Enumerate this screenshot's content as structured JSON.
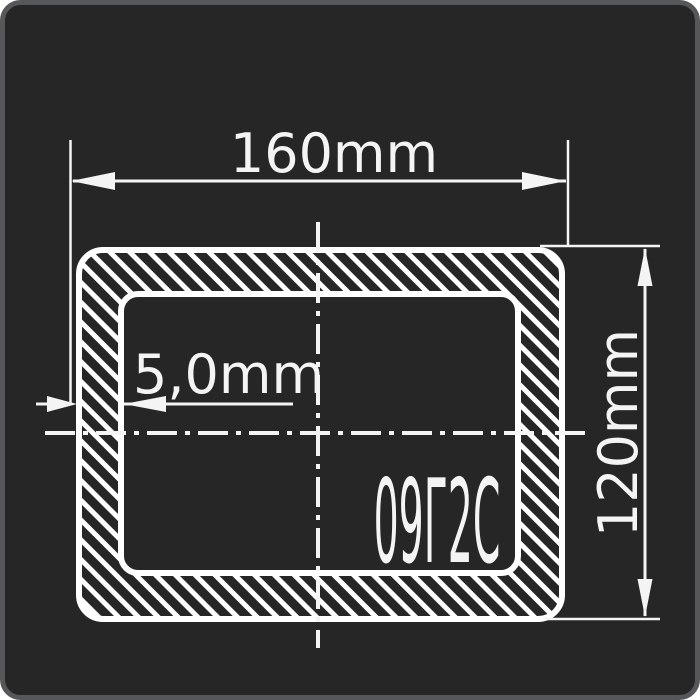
{
  "drawing": {
    "kind": "rectangular-tube-cross-section",
    "material_grade": "09Г2С",
    "dimensions": {
      "width": {
        "label": "160mm"
      },
      "height": {
        "label": "120mm"
      },
      "wall_thickness": {
        "label": "5,0mm"
      }
    },
    "colors": {
      "background": "#262626",
      "frame_border": "#56575a",
      "line": "#ffffff"
    }
  }
}
